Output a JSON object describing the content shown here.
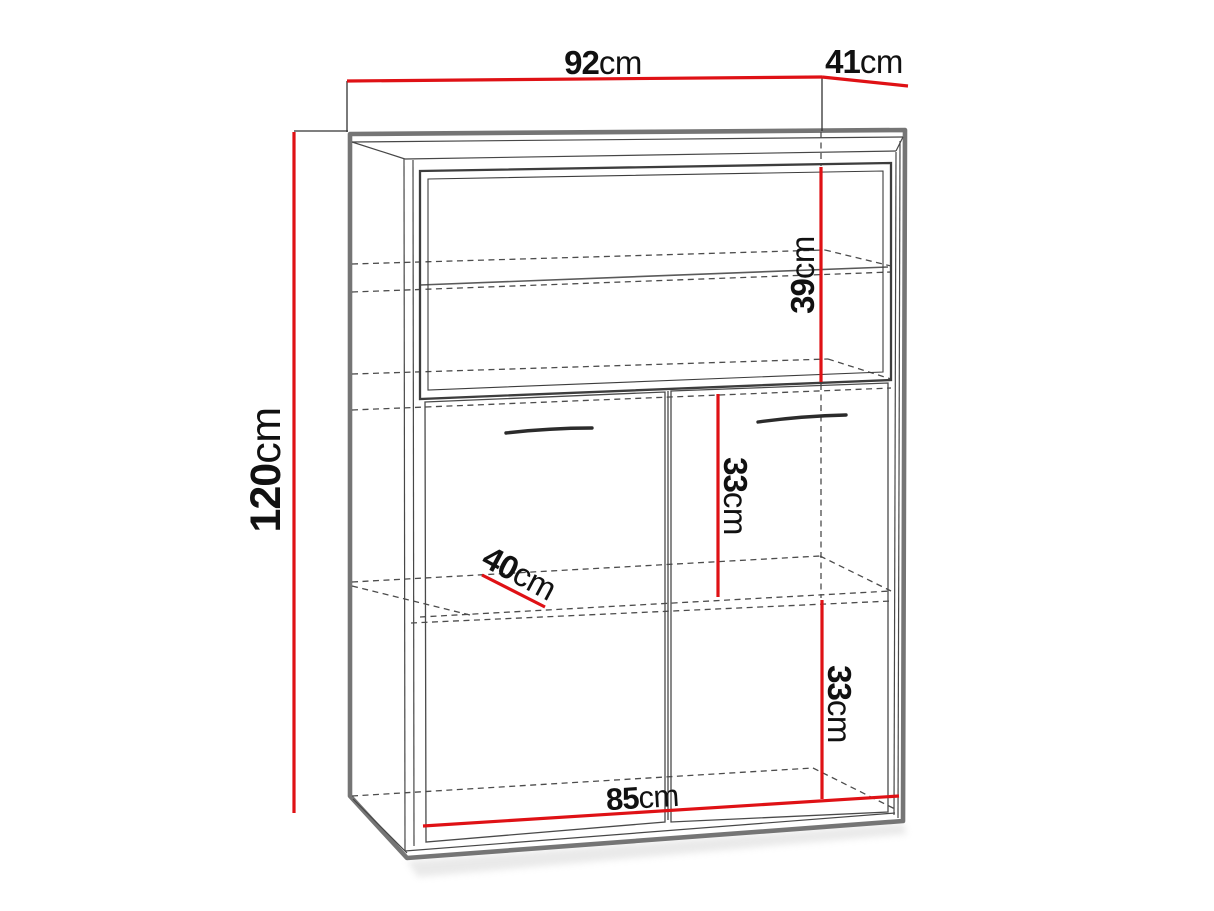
{
  "diagram": {
    "type": "furniture-dimension-drawing",
    "subject": "cabinet-with-display-top-and-two-doors",
    "unit": "cm",
    "dimensions": {
      "overall_width": {
        "number": "92",
        "unit": "cm",
        "value_cm": 92
      },
      "overall_depth": {
        "number": "41",
        "unit": "cm",
        "value_cm": 41
      },
      "overall_height": {
        "number": "120",
        "unit": "cm",
        "value_cm": 120
      },
      "top_section_height": {
        "number": "39",
        "unit": "cm",
        "value_cm": 39
      },
      "middle_section_height": {
        "number": "33",
        "unit": "cm",
        "value_cm": 33
      },
      "shelf_depth": {
        "number": "40",
        "unit": "cm",
        "value_cm": 40
      },
      "bottom_section_height": {
        "number": "33",
        "unit": "cm",
        "value_cm": 33
      },
      "inner_width": {
        "number": "85",
        "unit": "cm",
        "value_cm": 85
      }
    },
    "colors": {
      "dimension_line": "#df1115",
      "frame": "#757575",
      "line_detail": "#474747",
      "background": "#ffffff"
    }
  }
}
